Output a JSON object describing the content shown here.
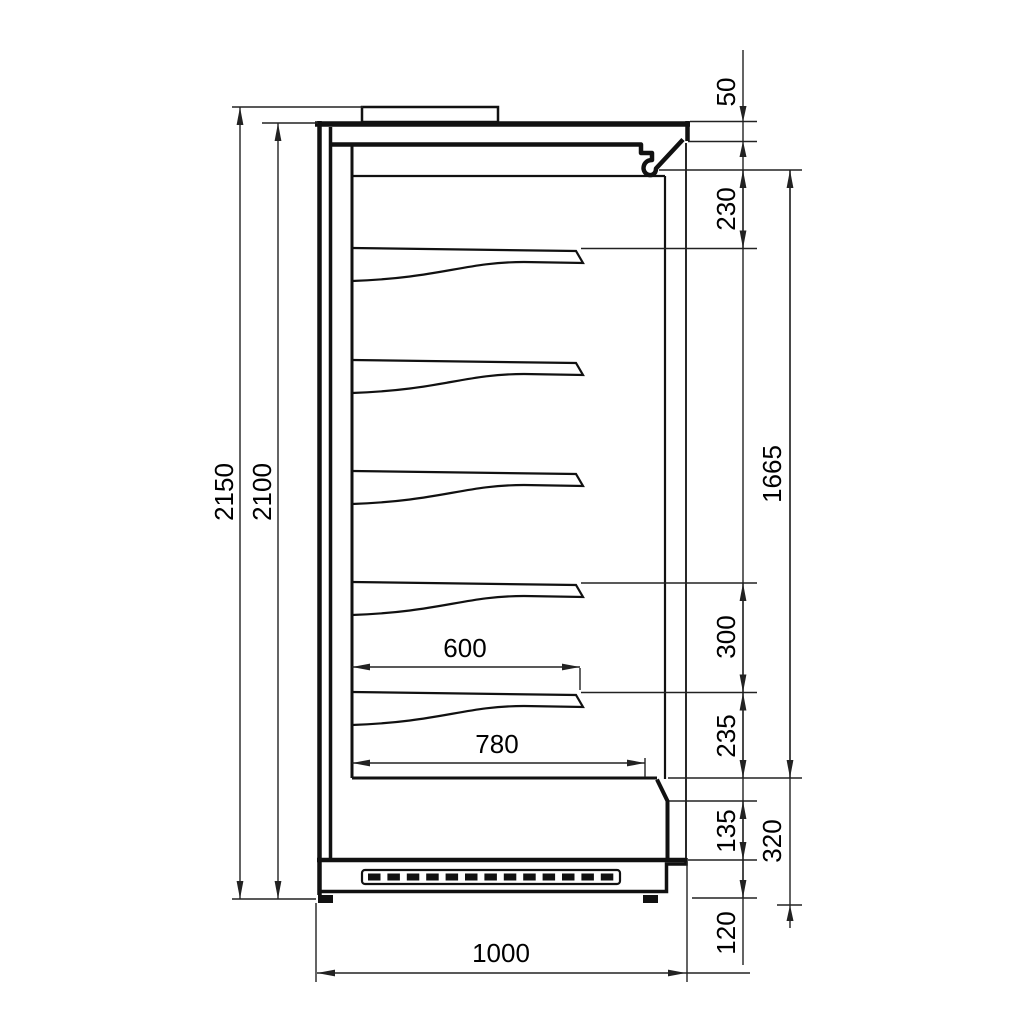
{
  "drawing": {
    "type": "technical-section-drawing",
    "subject": "refrigerated multideck display case side section",
    "background": "#ffffff",
    "line_color": "#111111",
    "units": "mm",
    "shelf_count": 5,
    "labels": {
      "overall_height": "2150",
      "case_height": "2100",
      "canopy_front": "50",
      "top_clearance": "230",
      "display_opening": "1665",
      "shelf_pitch": "300",
      "bottom_clearance": "235",
      "front_lower": "135",
      "base_height": "320",
      "plinth_height": "120",
      "shelf_depth": "600",
      "well_depth": "780",
      "overall_depth": "1000"
    }
  }
}
